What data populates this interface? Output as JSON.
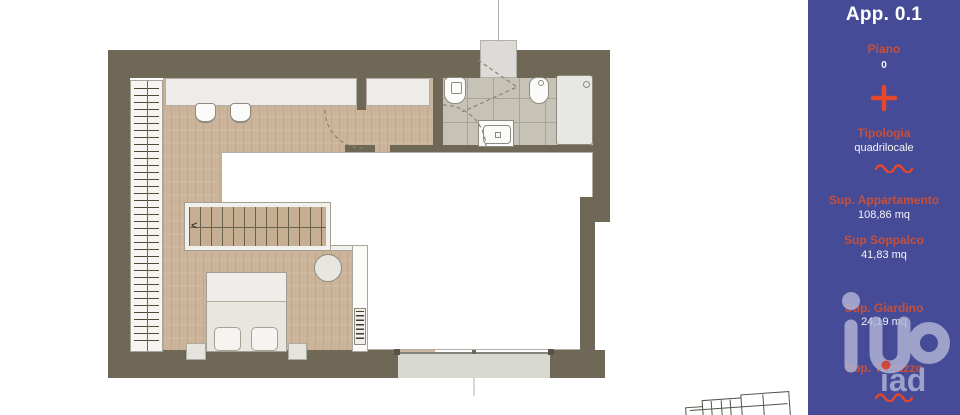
{
  "sidebar": {
    "title": "App. 0.1",
    "fields": [
      {
        "label": "Piano",
        "value": "0"
      },
      {
        "label": "Tipologia",
        "value": "quadrilocale"
      },
      {
        "label": "Sup. Appartamento",
        "value": "108,86 mq"
      },
      {
        "label": "Sup Soppalco",
        "value": "41,83 mq"
      },
      {
        "label": "Sup. Giardino",
        "value": "24,19 mq"
      },
      {
        "label": "Sup. Terrazzo",
        "value": ""
      }
    ],
    "watermark": "iad",
    "colors": {
      "panel_background": "#454b96",
      "accent_red": "#e5472c",
      "label_red": "#c6503b",
      "text_white": "#ffffff",
      "watermark": "#b2b6d6"
    }
  },
  "plan": {
    "stair_arrow": "<",
    "colors": {
      "wall": "#6f6856",
      "wood_floor": "#cbb499",
      "bath_tile": "#c6c2b6",
      "void_floor": "#ffffff"
    }
  }
}
